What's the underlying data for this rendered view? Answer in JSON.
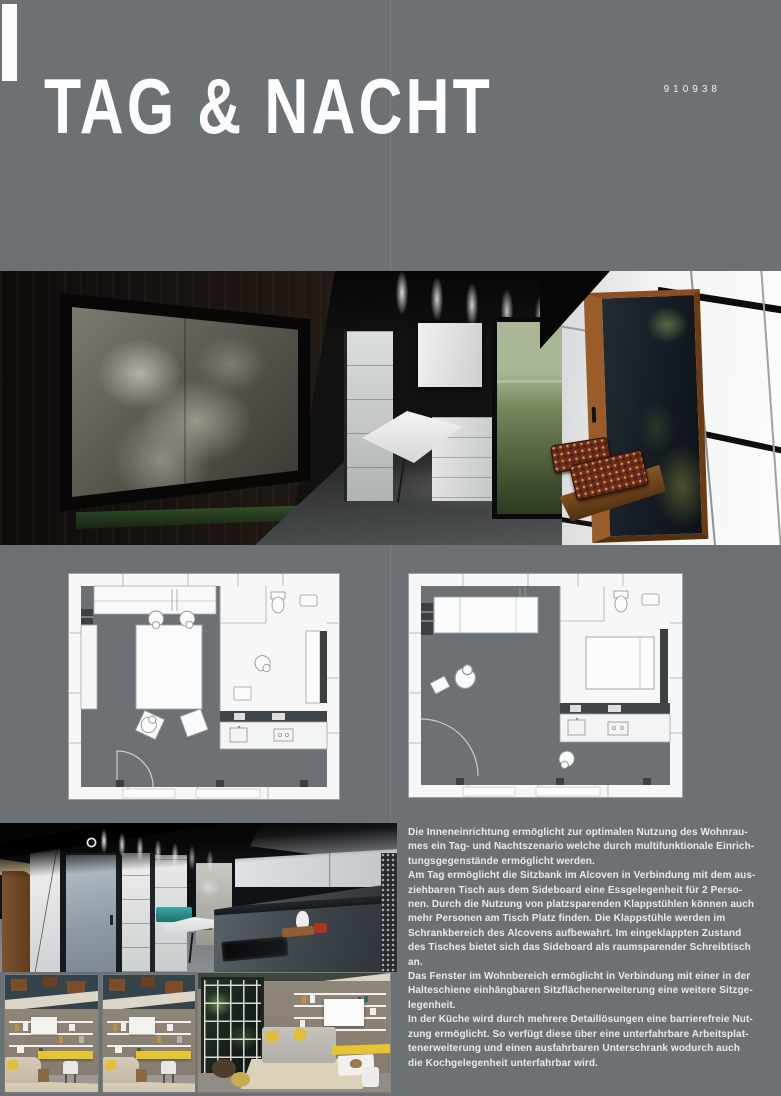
{
  "colors": {
    "page_bg": "#6c7175",
    "title_white": "#fdfdfd",
    "body_text": "#e8ebeb",
    "accent_yellow": "#e6c630",
    "bench_teal": "#2f9fa0",
    "garden_green": "#5d6f47",
    "wood_brown": "#8a4e20",
    "cushion_red": "#6e2a1a"
  },
  "header": {
    "title": "TAG & NACHT",
    "code": "910938"
  },
  "description": {
    "paragraph": "Die Inneneinrichtung ermöglicht zur optimalen Nutzung des Wohnrau-\nmes ein Tag- und Nachtszenario welche durch multifunktionale Einrich-\ntungsgegenstände ermöglicht werden.\nAm Tag ermöglicht die Sitzbank im Alcoven in Verbindung mit dem aus-\nziehbaren Tisch aus dem Sideboard eine Essgelegenheit für 2 Perso-\nnen. Durch die Nutzung von platzsparenden Klappstühlen können auch\nmehr Personen am Tisch Platz finden. Die Klappstühle werden im\nSchrankbereich des Alcovens aufbewahrt. Im eingeklappten Zustand\ndes Tisches bietet sich das Sideboard als raumsparender Schreibtisch\nan.\nDas Fenster im Wohnbereich ermöglicht in Verbindung mit einer in der\nHalteschiene einhängbaren Sitzflächenerweiterung eine weitere Sitzge-\nlegenheit.\nIn der Küche wird durch mehrere Detaillösungen eine barrierefreie Nut-\nzung ermöglicht. So verfügt diese über eine unterfahrbare Arbeitsplat-\ntenerweiterung und einen ausfahrbaren Unterschrank wodurch auch\ndie Kochgelegenheit unterfahrbar wird."
  }
}
